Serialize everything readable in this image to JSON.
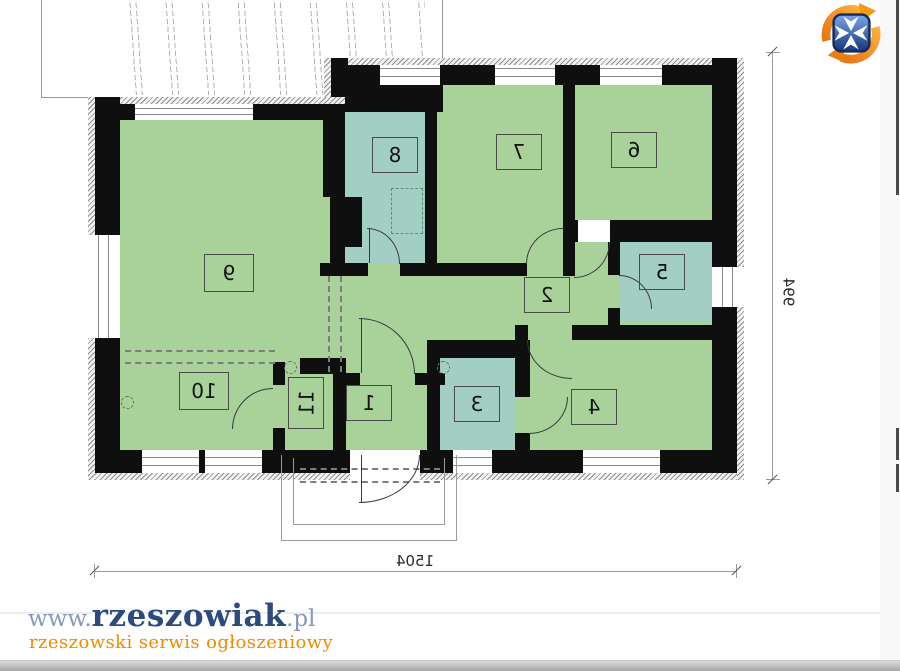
{
  "plan": {
    "rooms": {
      "r1": "1",
      "r2": "2",
      "r3": "3",
      "r4": "4",
      "r5": "5",
      "r6": "6",
      "r7": "7",
      "r8": "8",
      "r9": "9",
      "r10": "10",
      "r11": "11"
    },
    "dimensions": {
      "width": "1504",
      "height": "994"
    },
    "colors": {
      "room_green": "#a9d29a",
      "wet_room_teal": "#a2cec3",
      "wall_black": "#0f0f0f"
    }
  },
  "branding": {
    "prefix": "www.",
    "name": "rzeszowiak",
    "suffix": ".pl",
    "tagline": "rzeszowski serwis ogłoszeniowy",
    "colors": {
      "name_navy": "#2b4a7e",
      "tagline_orange": "#f08a00"
    }
  },
  "logo": {
    "alt": "rzeszowiak-logo",
    "shield_blue": "#1c3f8f",
    "swoosh_orange": "#f0961e"
  }
}
